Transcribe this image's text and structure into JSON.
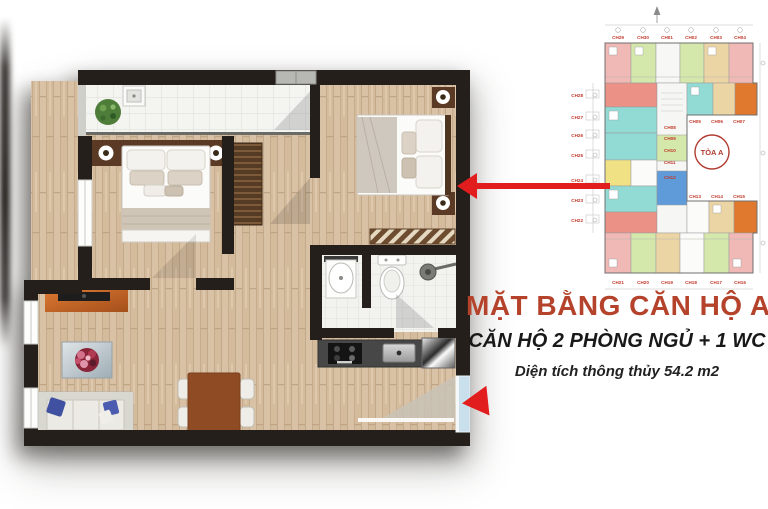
{
  "caption": {
    "title": "MẶT BẰNG CĂN HỘ A5",
    "subtitle": "CĂN HỘ 2 PHÒNG NGỦ + 1 WC",
    "area_note": "Diện tích thông thủy 54.2 m2"
  },
  "mini_plan": {
    "tower_label": "TÒA A",
    "top_labels": [
      "CH29",
      "CH30",
      "CH01",
      "CH02",
      "CH03",
      "CH04"
    ],
    "left_labels": [
      "CH28",
      "CH27",
      "CH26",
      "CH25",
      "CH24",
      "CH23",
      "CH22"
    ],
    "mid_top_labels": [
      "CH05",
      "CH06",
      "CH07"
    ],
    "mid_col_labels": [
      "CH08",
      "CH09",
      "CH10",
      "CH11",
      "CH12"
    ],
    "mid_bottom_labels": [
      "CH13",
      "CH14",
      "CH15"
    ],
    "bottom_labels": [
      "CH21",
      "CH20",
      "CH19",
      "CH18",
      "CH17",
      "CH16"
    ]
  },
  "colors": {
    "title_red": "#b5432c",
    "subtitle_dark": "#191919",
    "arrow_red": "#e21d1d",
    "wall_black": "#241f1b",
    "wood_floor": "#d8c1a4",
    "tile_white": "#f4f4f1",
    "window_blue": "#c9e0ec",
    "mini_pink": "#f0b9b5",
    "mini_green": "#d4e8ac",
    "mini_teal": "#92dbd5",
    "mini_orange": "#e0782e",
    "mini_yellow": "#f0e284",
    "mini_blue": "#5f9bd8",
    "mini_tan": "#ecd5a4",
    "mini_salmon": "#eb9186"
  }
}
